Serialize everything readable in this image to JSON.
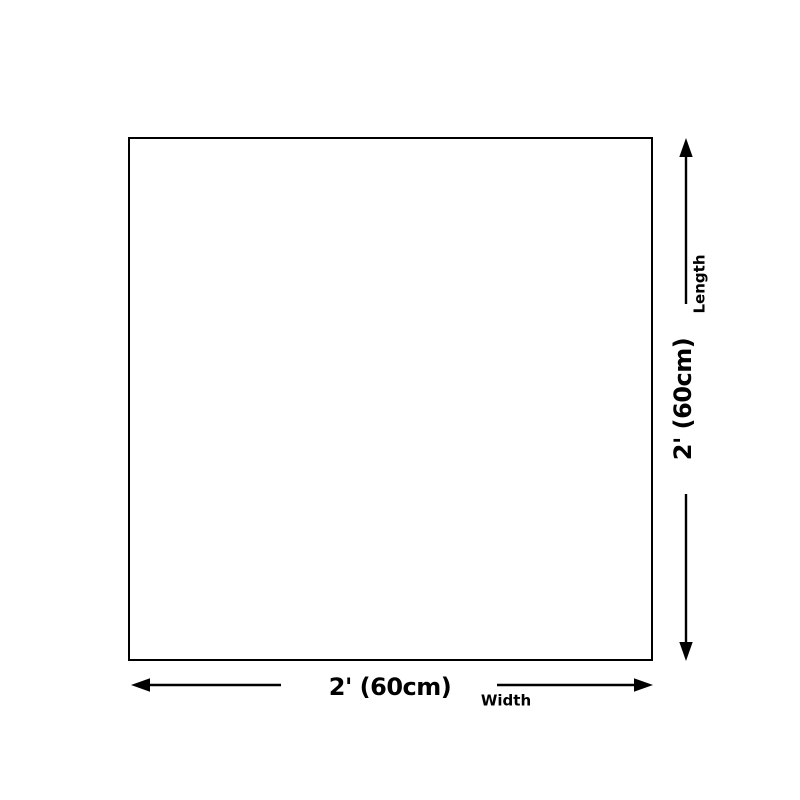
{
  "diagram": {
    "shape": "square-outline",
    "width": {
      "value": "2' (60cm)",
      "label": "Width"
    },
    "length": {
      "value": "2' (60cm)",
      "label": "Length"
    }
  },
  "colors": {
    "line": "#000000",
    "text": "#000000",
    "background": "#ffffff"
  }
}
